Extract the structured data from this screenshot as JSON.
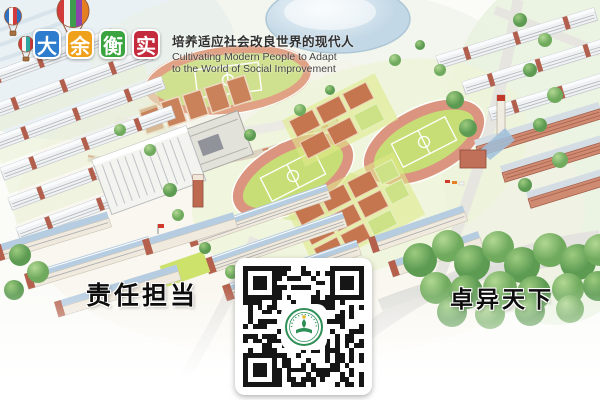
{
  "branding": {
    "characters": [
      {
        "char": "大",
        "color": "#2d7ccd"
      },
      {
        "char": "余",
        "color": "#f0a11b"
      },
      {
        "char": "衡",
        "color": "#3aa441"
      },
      {
        "char": "实",
        "color": "#c42b3c"
      }
    ]
  },
  "slogans": {
    "motto_cn": "培养适应社会改良世界的现代人",
    "motto_en_line1": "Cultivating Modern People to Adapt",
    "motto_en_line2": "to the World of Social Improvement",
    "bottom_left": "责任担当",
    "bottom_right": "卓异天下"
  },
  "qr_code": {
    "modules": 25,
    "dark_color": "#161616",
    "emblem_color": "#2e8f57",
    "emblem_accent": "#e8b731"
  },
  "scene": {
    "description": "Hand-drawn watercolor aerial view of a school campus with running tracks, courts, dormitory rows, teaching buildings, a domed gymnasium and trees",
    "colors": {
      "track_ring": "#db9480",
      "field_green": "#c7de76",
      "court_clay": "#c5764f",
      "roof_blue": "#b6cde1",
      "brick_red": "#b5604c",
      "tree_green": "#6fae62",
      "dome_blue": "#cfe0ec"
    }
  }
}
